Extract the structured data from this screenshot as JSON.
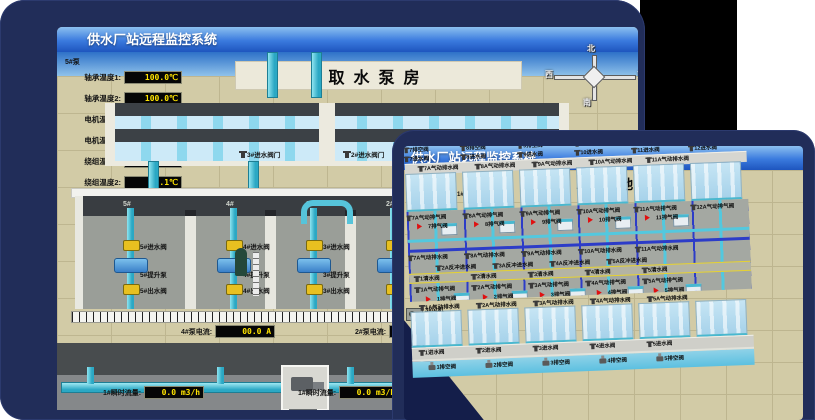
{
  "colors": {
    "desktop_navy": "#212d59",
    "titlebar_blue": "#3a7ade",
    "led_text_yellow": "#ffe400",
    "pipe_cyan": "#53c8de",
    "pipe_blue": "#2c3cc8",
    "valve_yellow": "#e8c020",
    "alarm_red": "#e01010",
    "ground_tan": "#d2cba6"
  },
  "back_window": {
    "title": "供水厂站远程监控系统",
    "scene_title": "取水泵房",
    "pump_panel": {
      "pump_no": "5#泵",
      "rows": [
        {
          "label": "轴承温度1:",
          "value": "100.0℃"
        },
        {
          "label": "轴承温度2:",
          "value": "100.0℃"
        },
        {
          "label": "电机温度1:",
          "value": "18.1℃"
        },
        {
          "label": "电机温度2:",
          "value": "17.9℃"
        },
        {
          "label": "绕组温度1:",
          "value": "18.0℃"
        },
        {
          "label": "绕组温度2:",
          "value": "18.1℃"
        },
        {
          "label": "绕组温度3:",
          "value": "18.1℃"
        },
        {
          "label": "管道压力:",
          "value": "0.0007MPa"
        },
        {
          "label": "多功能阀:",
          "value": "0%"
        }
      ]
    },
    "inlet_valves": [
      {
        "label": "3#进水阀门"
      },
      {
        "label": "2#进水阀门"
      },
      {
        "label": "1#进水阀门"
      }
    ],
    "compass": {
      "north": "北",
      "west": "西",
      "south": "南",
      "east": "东"
    },
    "right_labels": [
      {
        "label": "轴承温度1"
      },
      {
        "label": "轴承温度2"
      }
    ],
    "pump_room": {
      "bays": [
        {
          "no": "5#",
          "inlet": "5#进水阀",
          "pump": "5#提升泵",
          "outlet": "5#出水阀"
        },
        {
          "no": "4#",
          "inlet": "4#进水阀",
          "pump": "4#提升泵",
          "outlet": "4#出水阀"
        },
        {
          "no": "3#",
          "inlet": "3#进水阀",
          "pump": "3#提升泵",
          "outlet": "3#出水阀"
        },
        {
          "no": "2#",
          "inlet": "",
          "pump": "",
          "outlet": ""
        }
      ]
    },
    "current_meters": [
      {
        "label": "4#泵电流:",
        "value": "00.0 A"
      },
      {
        "label": "2#泵电流:",
        "value": ""
      }
    ],
    "flow_meters": [
      {
        "label": "1#瞬时流量:",
        "value": "0.0 m3/h"
      },
      {
        "label": "1#瞬时流量:",
        "value": "0.0 m3/h"
      }
    ]
  },
  "front_window": {
    "title": "供水厂站远程监控系统",
    "scene_title": "1#V滤池",
    "machines": [
      {
        "label": "1#水泵",
        "sub": ""
      },
      {
        "label": "2#水泵",
        "sub": ""
      },
      {
        "label": "3#水泵",
        "sub": ""
      },
      {
        "label": "1#风机",
        "sub": "流量"
      },
      {
        "label": "2#风机",
        "sub": "流量"
      },
      {
        "label": "3#风机",
        "sub": "流量"
      }
    ],
    "rows": {
      "top_drain": [
        "7排空阀",
        "8排空阀",
        "9排空阀",
        "10排空阀",
        "11排空阀",
        "12排空阀"
      ],
      "top_inlet": [
        "7进水阀",
        "8进水阀",
        "9进水阀",
        "10进水阀",
        "11进水阀",
        "12进水阀"
      ],
      "top_pneu_drain": [
        "7A气动排水阀",
        "8A气动排水阀",
        "9A气动排水阀",
        "10A气动排水阀",
        "11A气动排水阀"
      ],
      "gal_exhaust_a": [
        "7A气动排气阀",
        "8A气动排气阀",
        "9A气动排气阀",
        "10A气动排气阀",
        "11A气动排气阀",
        "12A气动排气阀"
      ],
      "gal_exhaust_a_red": [
        "7排气阀",
        "8排气阀",
        "9排气阀",
        "10排气阀",
        "11排气阀"
      ],
      "gal_drain_mid": [
        "7A气动排水阀",
        "8A气动排水阀",
        "9A气动排水阀",
        "10A气动排水阀",
        "11A气动排水阀"
      ],
      "gal_backwash": [
        "2A反冲进水阀",
        "3A反冲进水阀",
        "4A反冲进水阀",
        "5A反冲进水阀"
      ],
      "gal_clean": [
        "1清水阀",
        "2清水阀",
        "3清水阀",
        "4清水阀",
        "5清水阀"
      ],
      "gal_exhaust_b": [
        "1A气动排气阀",
        "2A气动排气阀",
        "3A气动排气阀",
        "4A气动排气阀",
        "5A气动排气阀"
      ],
      "gal_exhaust_b_red": [
        "1排气阀",
        "2排气阀",
        "3排气阀",
        "4排气阀",
        "5排气阀"
      ],
      "bot_pneu_drain": [
        "1A气动排水阀",
        "2A气动排水阀",
        "3A气动排水阀",
        "4A气动排水阀",
        "5A气动排水阀"
      ],
      "bot_inlet": [
        "1进水阀",
        "2进水阀",
        "3进水阀",
        "4进水阀",
        "5进水阀"
      ],
      "bot_drain": [
        "1排空阀",
        "2排空阀",
        "3排空阀",
        "4排空阀",
        "5排空阀"
      ]
    }
  }
}
